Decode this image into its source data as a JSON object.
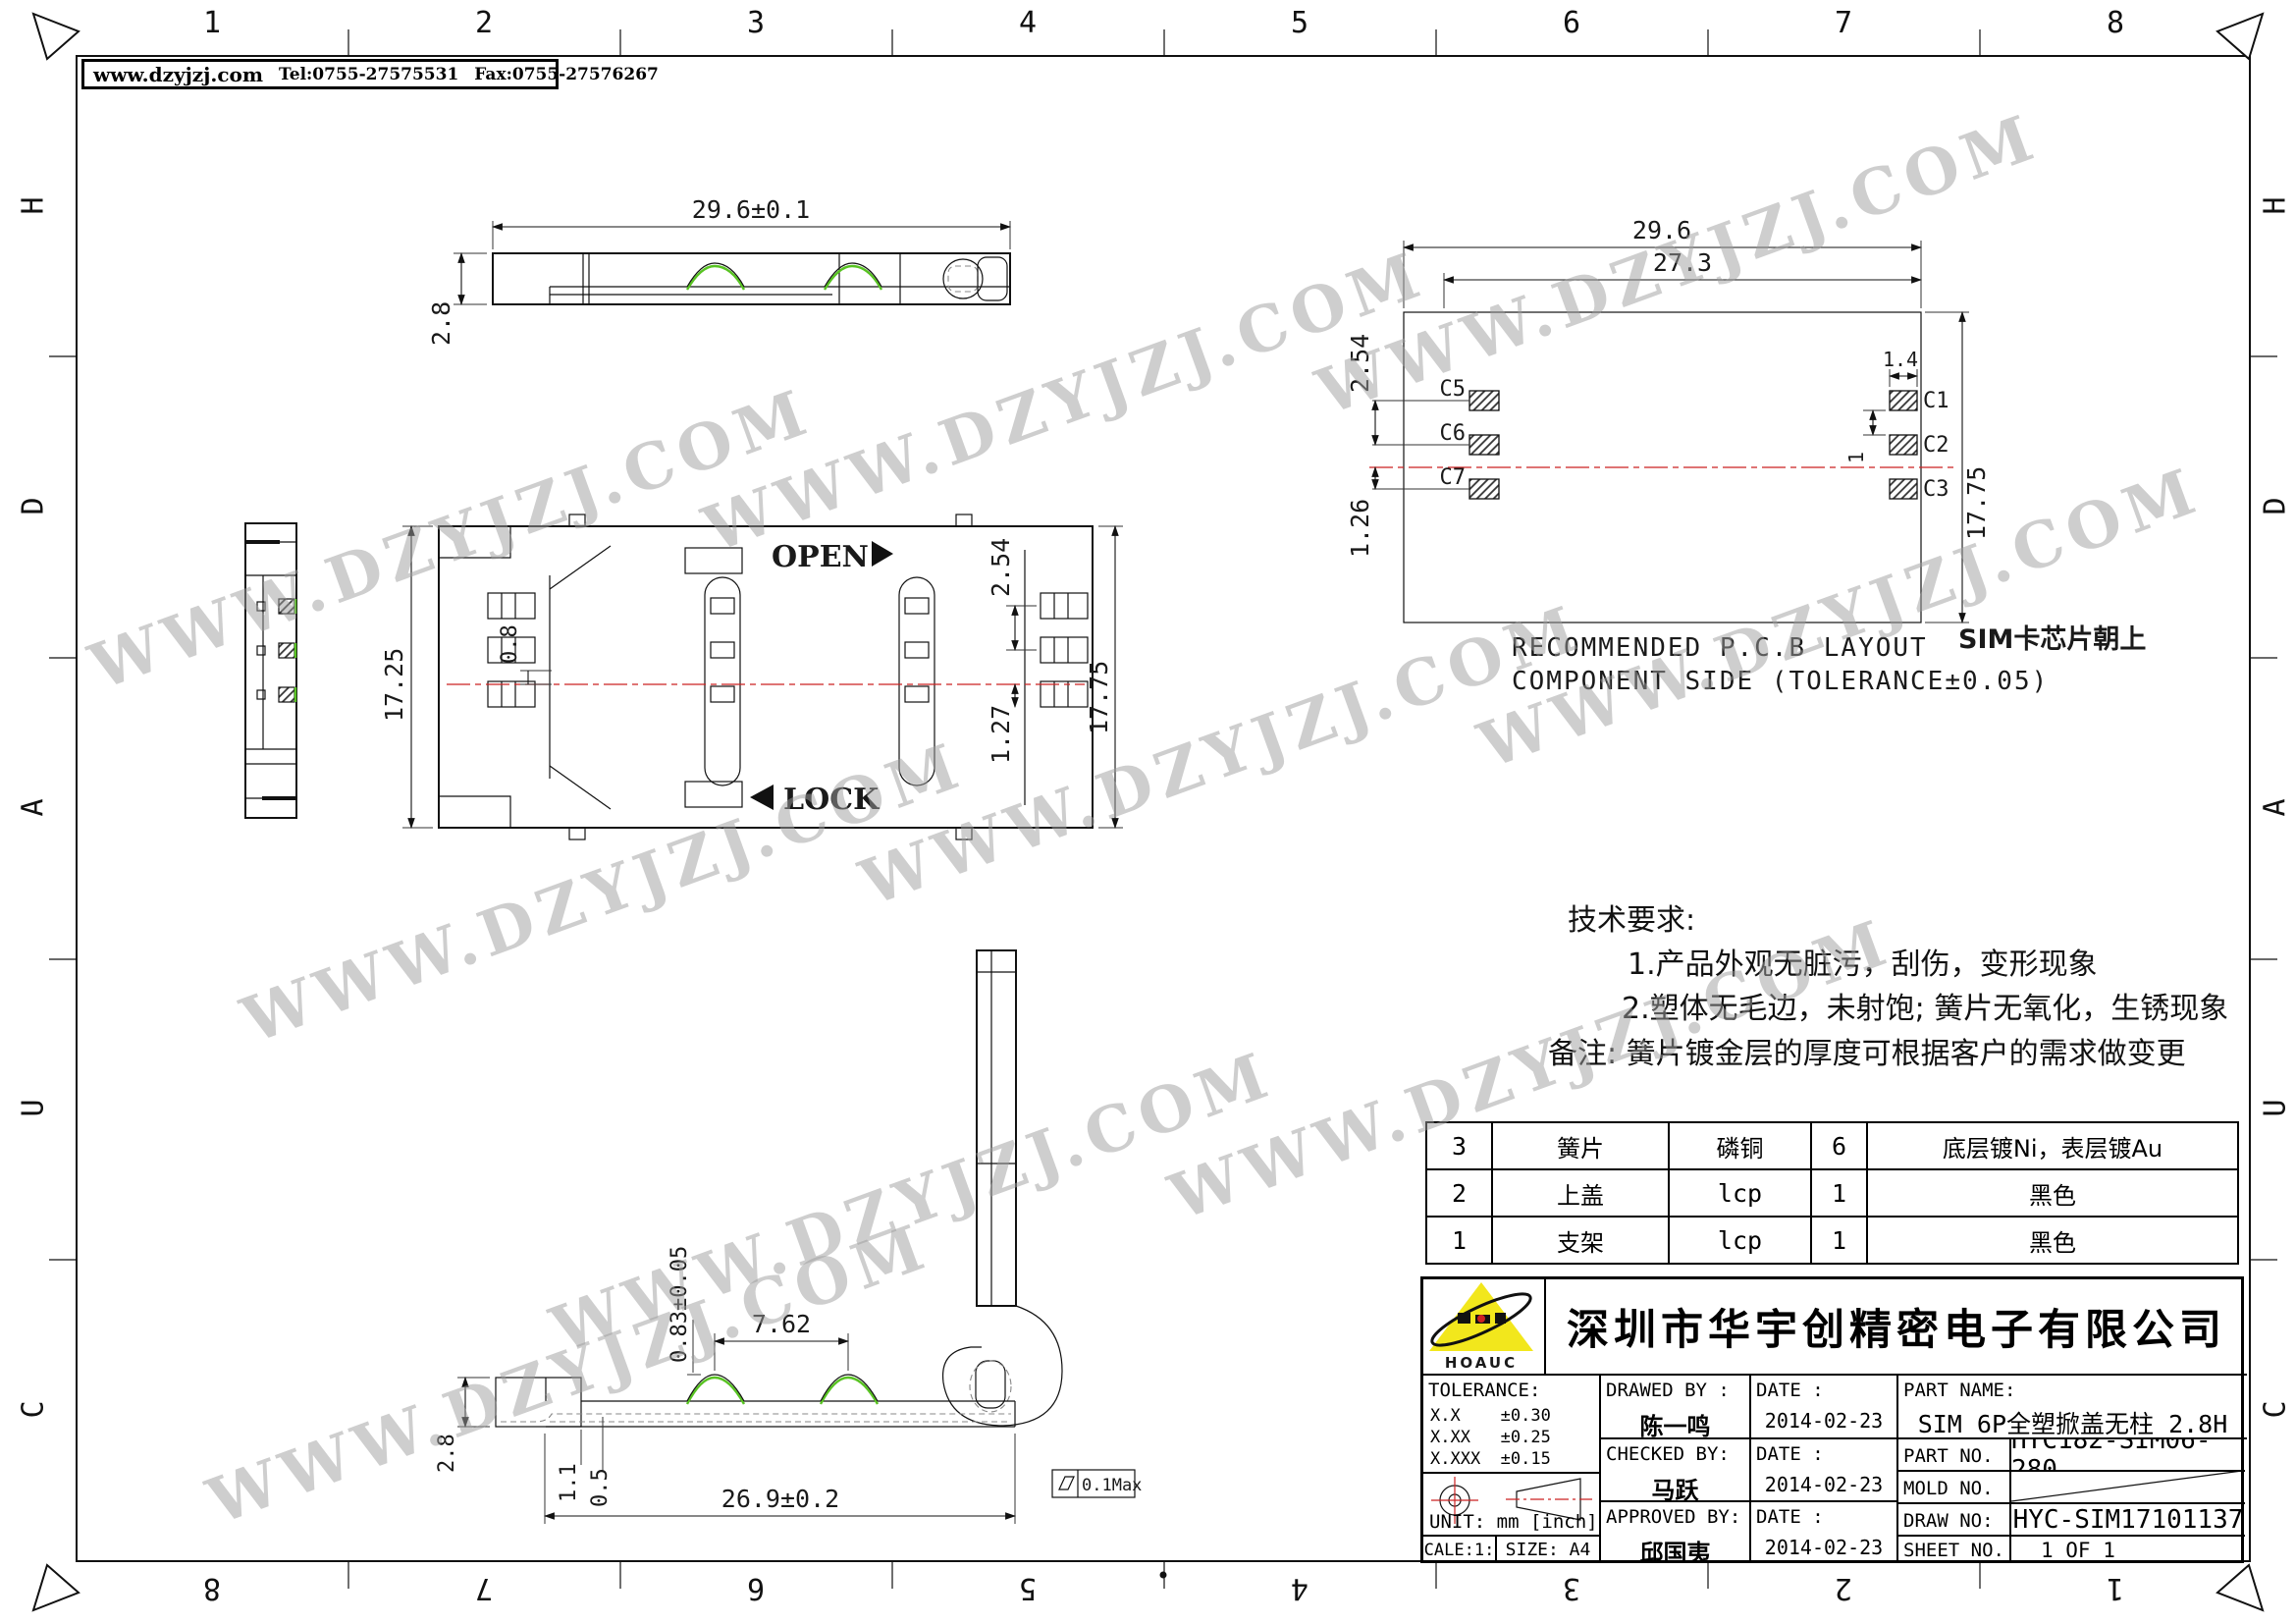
{
  "header": {
    "site": "www.dzyjzj.com",
    "tel": "Tel:0755-27575531",
    "fax": "Fax:0755-27576267"
  },
  "frame": {
    "cols": [
      "1",
      "2",
      "3",
      "4",
      "5",
      "6",
      "7",
      "8"
    ],
    "cols_rev": [
      "8",
      "7",
      "6",
      "5",
      "4",
      "3",
      "2",
      "1"
    ],
    "rows": [
      "H",
      "D",
      "A",
      "U",
      "C"
    ]
  },
  "watermark": {
    "text": "WWW.DZYJZJ.COM"
  },
  "views": {
    "top": {
      "dim_width": "29.6±0.1",
      "dim_height": "2.8"
    },
    "main": {
      "open_label": "OPEN",
      "lock_label": "LOCK",
      "dim_height_left": "17.25",
      "dim_contact": "0.8",
      "dim_pitch": "2.54",
      "dim_half_pitch": "1.27",
      "dim_height_right": "17.75"
    },
    "pcb": {
      "dim_width": "29.6",
      "dim_inner_width": "27.3",
      "dim_pad_width": "1.4",
      "dim_pad_gap": "1",
      "dim_height": "17.75",
      "dim_pitch": "2.54",
      "dim_offset": "1.26",
      "pads_left": [
        "C5",
        "C6",
        "C7"
      ],
      "pads_right": [
        "C1",
        "C2",
        "C3"
      ],
      "caption1": "RECOMMENDED P.C.B LAYOUT",
      "caption2": "COMPONENT SIDE (TOLERANCE±0.05)",
      "note": "SIM卡芯片朝上"
    },
    "bottom": {
      "dim_span": "7.62",
      "dim_bump": "0.83±0.05",
      "dim_height": "2.8",
      "dim_step1": "1.1",
      "dim_step2": "0.5",
      "dim_total": "26.9±0.2",
      "flatness": "0.1Max"
    }
  },
  "tech_notes": {
    "title": "技术要求:",
    "item1": "1.产品外观无脏污，刮伤，变形现象",
    "item2": "2.塑体无毛边，未射饱; 簧片无氧化，生锈现象",
    "remark": "备注: 簧片镀金层的厚度可根据客户的需求做变更"
  },
  "bom": {
    "rows": [
      {
        "no": "3",
        "name": "簧片",
        "material": "磷铜",
        "qty": "6",
        "note": "底层镀Ni，表层镀Au"
      },
      {
        "no": "2",
        "name": "上盖",
        "material": "lcp",
        "qty": "1",
        "note": "黑色"
      },
      {
        "no": "1",
        "name": "支架",
        "material": "lcp",
        "qty": "1",
        "note": "黑色"
      }
    ]
  },
  "title_block": {
    "logo_text": "HOAUC",
    "company": "深圳市华宇创精密电子有限公司",
    "tolerance_label": "TOLERANCE:",
    "tol_1": "X.X    ±0.30",
    "tol_2": "X.XX   ±0.25",
    "tol_3": "X.XXX  ±0.15",
    "tol_angle": "X.°  ±2°",
    "tol_angle2": "X.X°  ±0.5°",
    "unit": "UNIT:  mm  [inch]",
    "scale": "SCALE:1:1",
    "size": "SIZE:  A4",
    "drawed_label": "DRAWED  BY :",
    "drawed_name": "陈一鸣",
    "checked_label": "CHECKED  BY:",
    "checked_name": "马跃",
    "approved_label": "APPROVED  BY:",
    "approved_name": "邱国夷",
    "date_label": "DATE :",
    "date1": "2014-02-23",
    "date2": "2014-02-23",
    "date3": "2014-02-23",
    "part_name_label": "PART  NAME:",
    "part_name": "SIM 6P全塑掀盖无柱 2.8H",
    "part_no_label": "PART  NO.",
    "part_no": "HYC182-SIM06-280",
    "mold_label": "MOLD  NO.",
    "draw_label": "DRAW  NO:",
    "draw_no": "HYC-SIM17101137",
    "sheet_label": "SHEET  NO.",
    "sheet_no": "1 OF 1"
  },
  "colors": {
    "centerline_red": "#cc2222",
    "highlight_green": "#58c322",
    "logo_yellow": "#f2e71c"
  }
}
